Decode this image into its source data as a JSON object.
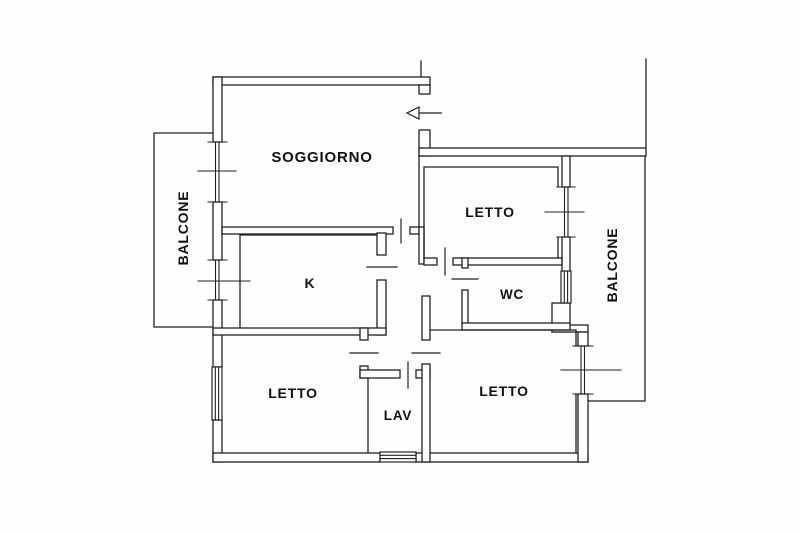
{
  "meta": {
    "document_type": "floor-plan",
    "background": "#fefefe",
    "ink_color": "#222222",
    "canvas_width": 800,
    "canvas_height": 533
  },
  "labels": [
    {
      "id": "soggiorno",
      "text": "SOGGIORNO",
      "x": 322,
      "y": 162,
      "size": 15,
      "rotate": 0
    },
    {
      "id": "balcone-left",
      "text": "BALCONE",
      "x": 188,
      "y": 228,
      "size": 14,
      "rotate": -90
    },
    {
      "id": "letto-top-right",
      "text": "LETTO",
      "x": 490,
      "y": 217,
      "size": 14,
      "rotate": 0
    },
    {
      "id": "balcone-right",
      "text": "BALCONE",
      "x": 617,
      "y": 265,
      "size": 14,
      "rotate": -90
    },
    {
      "id": "kitchen",
      "text": "K",
      "x": 310,
      "y": 288,
      "size": 14,
      "rotate": 0
    },
    {
      "id": "wc",
      "text": "WC",
      "x": 512,
      "y": 299,
      "size": 13.5,
      "rotate": 0
    },
    {
      "id": "letto-bottom-left",
      "text": "LETTO",
      "x": 293,
      "y": 398,
      "size": 14,
      "rotate": 0
    },
    {
      "id": "lav",
      "text": "LAV",
      "x": 398,
      "y": 420,
      "size": 13.5,
      "rotate": 0
    },
    {
      "id": "letto-bottom-right",
      "text": "LETTO",
      "x": 504,
      "y": 396,
      "size": 14,
      "rotate": 0
    }
  ],
  "plan": {
    "boundary_lines": [
      {
        "id": "party-line-entrance",
        "d": "M421,61 V77"
      },
      {
        "id": "party-line-right",
        "d": "M646,59 V148"
      }
    ],
    "balconies": [
      {
        "id": "balcony-left-outline",
        "d": "M213,133 H154 V327 H213"
      },
      {
        "id": "balcony-right-outline",
        "d": "M645,156 V401 H588"
      }
    ],
    "wall_rects": [
      {
        "id": "wall-top",
        "r": [
          213,
          77,
          217,
          8
        ]
      },
      {
        "id": "wall-left-a",
        "r": [
          213,
          77,
          9,
          65
        ]
      },
      {
        "id": "wall-left-b",
        "r": [
          213,
          202,
          9,
          58
        ]
      },
      {
        "id": "wall-left-c",
        "r": [
          213,
          300,
          9,
          67
        ]
      },
      {
        "id": "wall-left-d",
        "r": [
          213,
          420,
          9,
          42
        ]
      },
      {
        "id": "wall-bottom-a",
        "r": [
          213,
          453,
          167,
          9
        ]
      },
      {
        "id": "wall-bottom-b",
        "r": [
          416,
          453,
          172,
          9
        ]
      },
      {
        "id": "entrance-jamb-upper",
        "r": [
          419,
          85,
          11,
          9
        ]
      },
      {
        "id": "entrance-jamb-lower",
        "r": [
          419,
          130,
          11,
          26
        ]
      },
      {
        "id": "wall-top-right",
        "r": [
          419,
          148,
          227,
          8
        ]
      },
      {
        "id": "wall-right-upper-a",
        "r": [
          562,
          156,
          8,
          31
        ]
      },
      {
        "id": "wall-right-upper-b",
        "r": [
          562,
          237,
          8,
          35
        ]
      },
      {
        "id": "wall-wc-corner",
        "r": [
          552,
          303,
          18,
          29
        ]
      },
      {
        "id": "wall-step-right",
        "r": [
          552,
          325,
          36,
          7
        ]
      },
      {
        "id": "wall-right-lower-a",
        "r": [
          578,
          332,
          10,
          14
        ]
      },
      {
        "id": "wall-right-lower-b",
        "r": [
          578,
          394,
          10,
          68
        ]
      },
      {
        "id": "wall-sog-bottom-a",
        "r": [
          222,
          227,
          171,
          7
        ]
      },
      {
        "id": "wall-sog-bottom-b",
        "r": [
          410,
          227,
          9,
          7
        ]
      },
      {
        "id": "wall-hall-letto-tr",
        "r": [
          419,
          227,
          5,
          37
        ]
      },
      {
        "id": "wall-letto-tr-bottom-a",
        "r": [
          424,
          258,
          13,
          7
        ]
      },
      {
        "id": "wall-letto-tr-bottom-b",
        "r": [
          453,
          258,
          109,
          7
        ]
      },
      {
        "id": "wall-wc-left-a",
        "r": [
          462,
          258,
          6,
          10
        ]
      },
      {
        "id": "wall-wc-left-b",
        "r": [
          462,
          290,
          6,
          35
        ]
      },
      {
        "id": "wall-wc-bottom",
        "r": [
          462,
          323,
          108,
          7
        ]
      },
      {
        "id": "wall-k-right-a",
        "r": [
          377,
          233,
          9,
          22
        ]
      },
      {
        "id": "wall-k-right-b",
        "r": [
          377,
          280,
          9,
          55
        ]
      },
      {
        "id": "wall-k-bottom",
        "r": [
          213,
          328,
          173,
          7
        ]
      },
      {
        "id": "wall-letto-bl-hall-a",
        "r": [
          360,
          328,
          8,
          12
        ]
      },
      {
        "id": "wall-letto-bl-hall-b",
        "r": [
          360,
          366,
          8,
          12
        ]
      },
      {
        "id": "wall-lav-top-a",
        "r": [
          360,
          370,
          40,
          8
        ]
      },
      {
        "id": "wall-lav-top-b",
        "r": [
          416,
          370,
          14,
          8
        ]
      },
      {
        "id": "wall-hall-letto-br-a",
        "r": [
          422,
          296,
          8,
          44
        ]
      },
      {
        "id": "wall-hall-letto-br-b",
        "r": [
          422,
          364,
          8,
          98
        ]
      }
    ],
    "room_edges": [
      {
        "id": "soggiorno-right-face",
        "d": "M419,156 V227"
      },
      {
        "id": "kitchen-room",
        "d": "M377,235 H240 V328"
      },
      {
        "id": "letto-tr-room",
        "d": "M424,258 V167 H558 V187 M558,237 V258"
      },
      {
        "id": "letto-br-room",
        "d": "M430,330 H576 V346 M576,394 V452"
      },
      {
        "id": "lav-left-edge",
        "d": "M368,378 V452"
      }
    ],
    "door_ticks": [
      {
        "id": "door-soggiorno-hall",
        "d": "M401,219 V243"
      },
      {
        "id": "door-kitchen",
        "d": "M367,267 H397"
      },
      {
        "id": "door-letto-tr",
        "d": "M445,248 V275"
      },
      {
        "id": "door-wc",
        "d": "M452,279 H478"
      },
      {
        "id": "door-letto-bl",
        "d": "M350,353 H378"
      },
      {
        "id": "door-letto-br",
        "d": "M412,353 H440"
      },
      {
        "id": "door-lav",
        "d": "M408,362 V388"
      }
    ],
    "window_symbols": [
      {
        "id": "window-soggiorno-balcony",
        "d": "M208,142 H227 M208,202 H227 M215.5,142 V202 M219,142 V202 M198,171 H236"
      },
      {
        "id": "window-kitchen-balcony",
        "d": "M208,260 H227 M208,300 H227 M215.5,260 V300 M219,260 V300 M198,281 H250"
      },
      {
        "id": "window-letto-tr-balcony",
        "d": "M557,187 H575 M557,237 H575 M564.5,187 V237 M568,187 V237 M545,212 H584"
      },
      {
        "id": "window-letto-br-balcony",
        "d": "M573,346 H593 M573,394 H593 M581,346 V394 M584.5,346 V394 M561,370 H621"
      }
    ],
    "hatch_windows": [
      {
        "id": "window-letto-bl-fixed",
        "rect": [
          212,
          367,
          10,
          53
        ],
        "stripes": "M215.3,367 V420 M218.6,367 V420"
      },
      {
        "id": "window-wc-fixed",
        "rect": [
          561,
          271,
          10,
          32
        ],
        "stripes": "M564.3,271 V303 M567.6,271 V303"
      },
      {
        "id": "window-lav-fixed",
        "rect": [
          380,
          452,
          36,
          10
        ],
        "stripes": "M380,455.3 H416 M380,458.6 H416"
      }
    ],
    "entrance_arrow": {
      "shaft": "M442,113 H419",
      "head_points": "419,107 407,113 419,119"
    }
  }
}
